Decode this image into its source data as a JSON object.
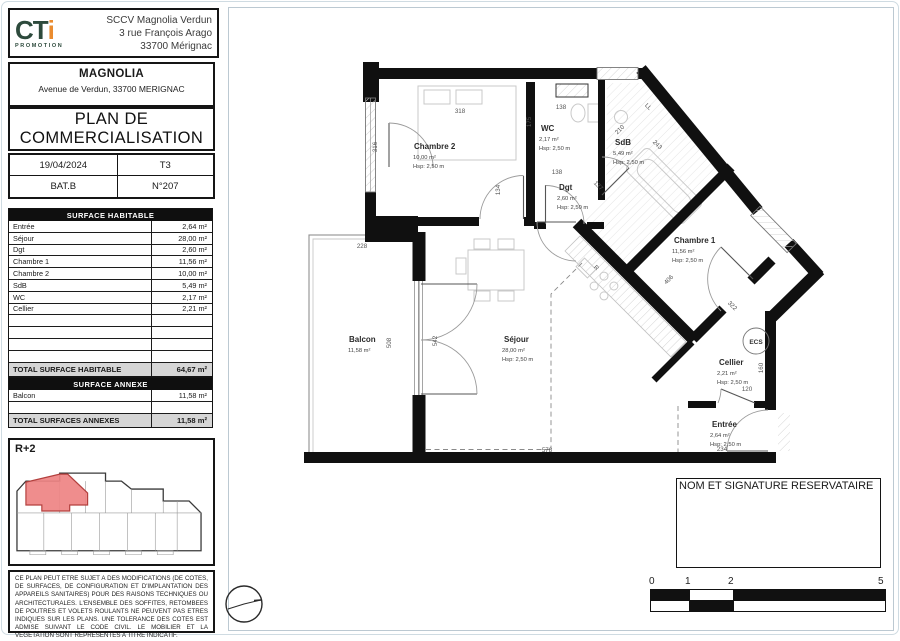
{
  "company": {
    "logo_ct": "CT",
    "logo_i": "i",
    "logo_sub": "PROMOTION",
    "name": "SCCV Magnolia Verdun",
    "address1": "3 rue François Arago",
    "address2": "33700 Mérignac"
  },
  "project": {
    "name": "MAGNOLIA",
    "address": "Avenue de Verdun, 33700 MERIGNAC"
  },
  "doc_title": {
    "line1": "PLAN DE",
    "line2": "COMMERCIALISATION"
  },
  "info": {
    "date": "19/04/2024",
    "type": "T3",
    "building": "BAT.B",
    "number": "N°207"
  },
  "surface_habitable": {
    "title": "SURFACE HABITABLE",
    "rows": [
      {
        "label": "Entrée",
        "value": "2,64 m²"
      },
      {
        "label": "Séjour",
        "value": "28,00 m²"
      },
      {
        "label": "Dgt",
        "value": "2,60 m²"
      },
      {
        "label": "Chambre 1",
        "value": "11,56 m²"
      },
      {
        "label": "Chambre 2",
        "value": "10,00 m²"
      },
      {
        "label": "SdB",
        "value": "5,49 m²"
      },
      {
        "label": "WC",
        "value": "2,17 m²"
      },
      {
        "label": "Cellier",
        "value": "2,21 m²"
      }
    ],
    "total_label": "TOTAL SURFACE HABITABLE",
    "total_value": "64,67 m²"
  },
  "surface_annexe": {
    "title": "SURFACE ANNEXE",
    "rows": [
      {
        "label": "Balcon",
        "value": "11,58 m²"
      }
    ],
    "total_label": "TOTAL SURFACES ANNEXES",
    "total_value": "11,58 m²"
  },
  "level": "R+2",
  "disclaimer": "CE PLAN PEUT ETRE SUJET A DES MODIFICATIONS (DE COTES, DE SURFACES, DE CONFIGURATION ET D'IMPLANTATION DES APPAREILS SANITAIRES) POUR DES RAISONS TECHNIQUES OU ARCHITECTURALES. L'ENSEMBLE DES SOFFITES, RETOMBEES DE POUTRES ET VOLETS ROULANTS NE PEUVENT PAS ETRES INDIQUES SUR LES PLANS. UNE TOLERANCE DES COTES EST ADMISE SUIVANT LE CODE CIVIL. LE MOBILIER ET LA VEGETATION SONT REPRESENTES A TITRE INDICATIF.",
  "signature": {
    "label": "NOM ET SIGNATURE RESERVATAIRE"
  },
  "scalebar": {
    "t0": "0",
    "t1": "1",
    "t2": "2",
    "t5": "5"
  },
  "plan": {
    "rooms": {
      "chambre2": {
        "name": "Chambre 2",
        "area": "10,00 m²",
        "hsp": "Hsp: 2,50 m"
      },
      "wc": {
        "name": "WC",
        "area": "2,17 m²",
        "hsp": "Hsp: 2,50 m"
      },
      "dgt": {
        "name": "Dgt",
        "area": "2,60 m²",
        "hsp": "Hsp: 2,50 m"
      },
      "sdb": {
        "name": "SdB",
        "area": "5,49 m²",
        "hsp": "Hsp: 2,50 m"
      },
      "chambre1": {
        "name": "Chambre 1",
        "area": "11,56 m²",
        "hsp": "Hsp: 2,50 m"
      },
      "sejour": {
        "name": "Séjour",
        "area": "28,00 m²",
        "hsp": "Hsp: 2,50 m"
      },
      "balcon": {
        "name": "Balcon",
        "area": "11,58 m²"
      },
      "cellier": {
        "name": "Cellier",
        "area": "2,21 m²",
        "hsp": "Hsp: 2,50 m"
      },
      "entree": {
        "name": "Entrée",
        "area": "2,64 m²",
        "hsp": "Hsp: 2,50 m"
      }
    },
    "dims": {
      "d318": "318",
      "d316": "316",
      "d228": "228",
      "d508": "508",
      "d542": "542",
      "d578": "578",
      "d175": "175",
      "d138a": "138",
      "d138b": "138",
      "d134": "134",
      "d137": "137",
      "d210": "210",
      "d243": "243",
      "d406": "406",
      "d322": "322",
      "d160": "160",
      "d120": "120",
      "d234": "234"
    },
    "equip": {
      "ecs": "ECS",
      "ll": "LL",
      "fridge": "R"
    }
  },
  "colors": {
    "accent_green": "#2d4a3c",
    "accent_orange": "#ea8c2f",
    "highlight_red": "#ee8383"
  }
}
